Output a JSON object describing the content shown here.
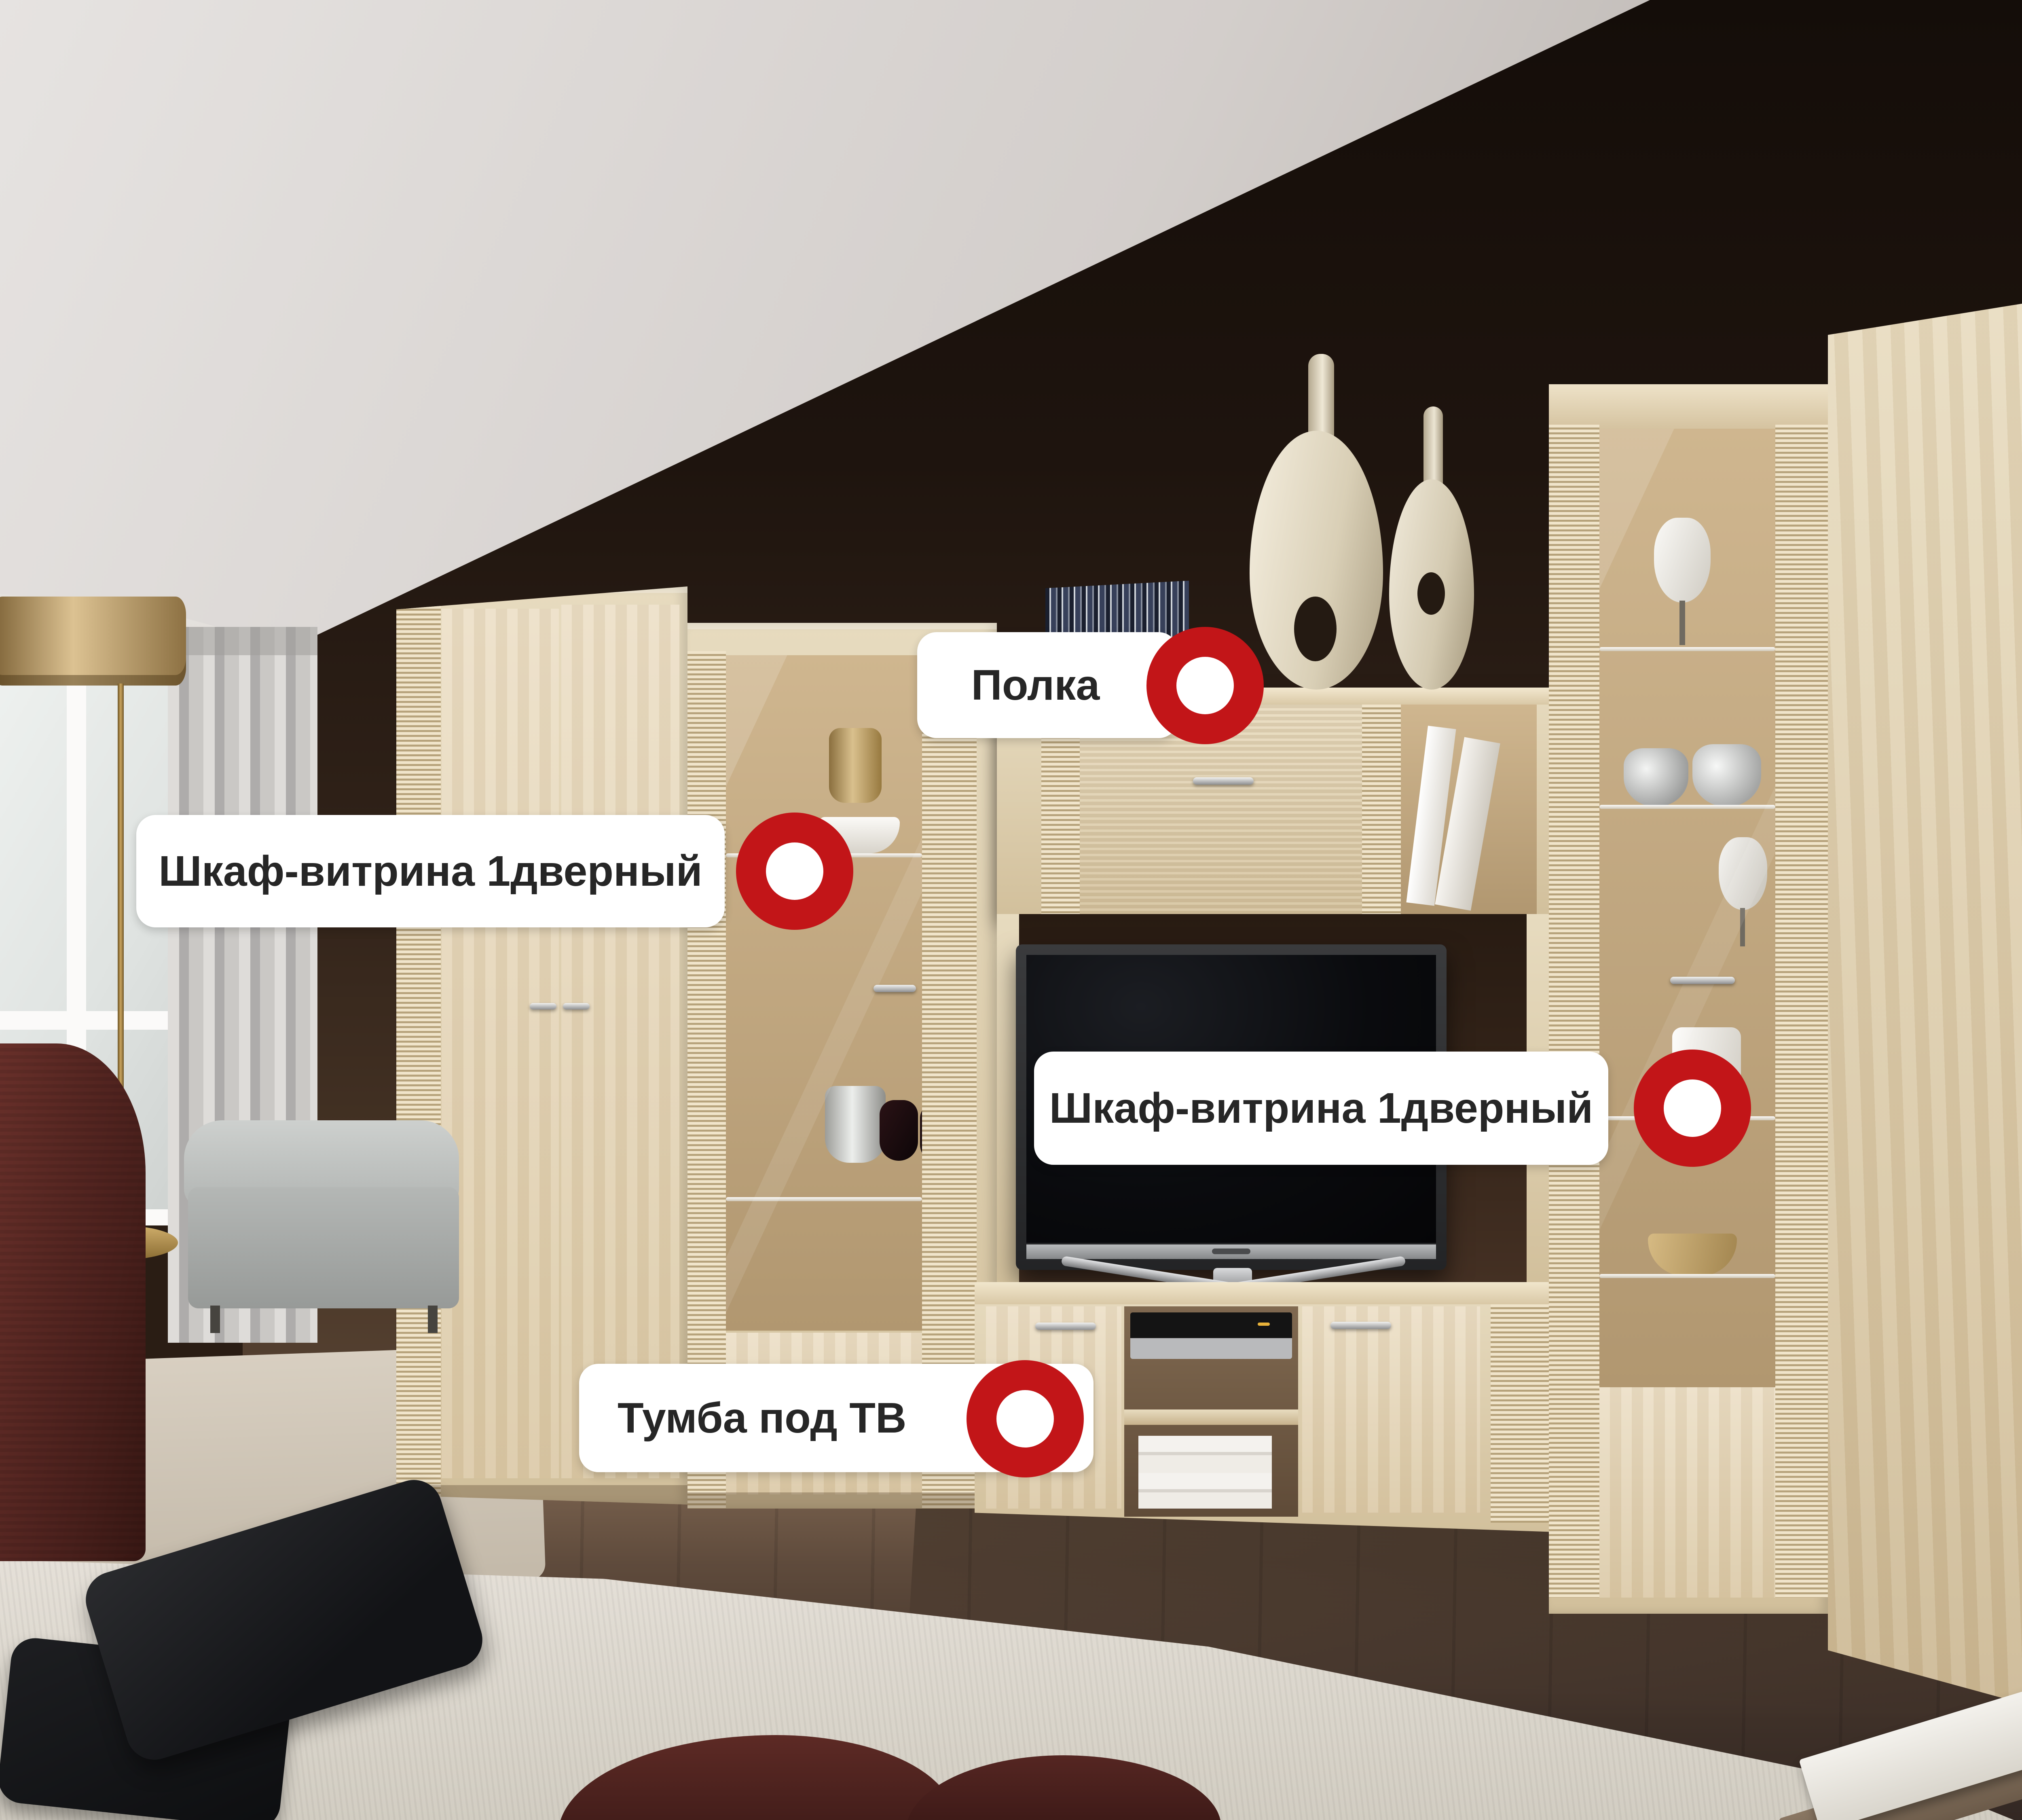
{
  "labels": [
    {
      "id": "shelf",
      "text": "Полка"
    },
    {
      "id": "vitrine-left",
      "text": "Шкаф-витрина 1дверный"
    },
    {
      "id": "vitrine-right",
      "text": "Шкаф-витрина 1дверный"
    },
    {
      "id": "tv-stand",
      "text": "Тумба под ТВ"
    }
  ],
  "theme": {
    "accent_red": "#c21518",
    "label_bg": "#ffffff",
    "label_text": "#262626",
    "wood_light": "#e7dbbf",
    "wood_mid": "#d2c09c",
    "wood_texture_dark": "#b7a37c",
    "wall_dark": "#1e140e",
    "wall_warm": "#4c3929",
    "ceiling_gray": "#d3cecb",
    "curtain_gray": "#bcbab7",
    "sofa_gray": "#b6b9b7",
    "chair_burgundy": "#52241f",
    "lamp_gold": "#c0a267",
    "floor_dark": "#3e3028",
    "rug_cream": "#ddd8cd",
    "pillow_black": "#17181a",
    "blanket_maroon": "#4e211e",
    "tv_black": "#0a0a0d",
    "silver": "#c8c9ca"
  }
}
